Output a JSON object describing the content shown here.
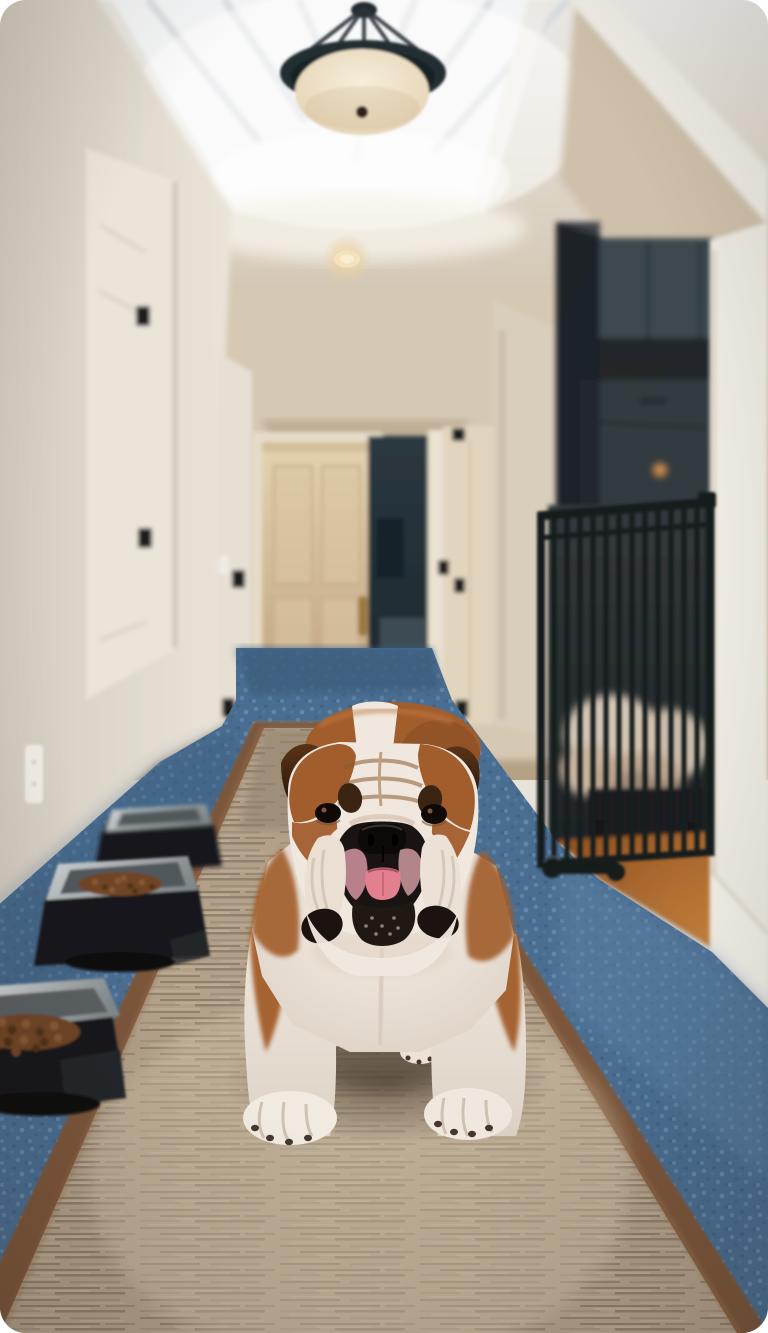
{
  "meta": {
    "media_type": "photograph",
    "subject": "english-bulldog-in-hallway",
    "alt": "A brown and white English Bulldog stands facing the camera on a tan runner rug in a bright hallway with a skylight and pendant light; three raised food bowls line the left wall and a black metal pet gate closes off a room to the right."
  },
  "scene": {
    "dog": {
      "breed": "English Bulldog",
      "coat": "chestnut brown and white",
      "pose": "standing, facing camera",
      "tongue_out": true
    },
    "hallway": {
      "skylight": true,
      "pendant_light": true,
      "recessed_lights": 3,
      "doors_visible": 4,
      "open_doorway": true,
      "wall_outlet": true
    },
    "floor": {
      "carpet": "steel blue",
      "runner": "tan with brown leather binding",
      "wood": "orange oak behind pet gate"
    },
    "objects": [
      "raised dog bowl x3",
      "kibble",
      "black metal pet gate",
      "door mat",
      "brass door handle",
      "fluffy dog bed behind gate"
    ]
  },
  "palette": {
    "wall_left": "#dbd4c9",
    "wall_right": "#edeae2",
    "ceiling": "#d8cdbc",
    "ceiling_deep": "#c2ad93",
    "skylight": "#f4f5f6",
    "skylight_beam": "#d9dcde",
    "pendant_dark": "#242d33",
    "pendant_glass": "#f6eedb",
    "glass_edge": "#e2cfae",
    "recessed_glow": "#f2dcae",
    "end_wall": "#d6c9b3",
    "end_door": "#e4d2b2",
    "end_door_deep": "#bda17c",
    "door_frame": "#e7dcc8",
    "doorway_dark": "#2b3840",
    "doorway_deep": "#1c262d",
    "left_door": "#eae4d9",
    "right_door": "#e2d5bd",
    "hinge": "#1a1a1a",
    "brass": "#9a7634",
    "alcove": "#cec0aa",
    "room_dark": "#262220",
    "cabinet": "#3c4a50",
    "cabinet_dark": "#313b40",
    "knob_light": "#c98a4a",
    "gate": "#171a1d",
    "fluff": "#dccdbc",
    "bench": "#1b1f22",
    "wood": "#8a4d1f",
    "wood_bright": "#c8823c",
    "carpet": "#4a6e92",
    "carpet_light": "#7fa2c0",
    "carpet_dark": "#3c5d7d",
    "runner": "#b2a089",
    "runner_light": "#cdbda4",
    "runner_streak": "#6e5f4e",
    "runner_border": "#7c563a",
    "border_light": "#9a7352",
    "mat": "#c2a87c",
    "bowl": "#17191d",
    "steel": "#d2d6d7",
    "steel_dark": "#82898c",
    "steel_inner": "#51585c",
    "kibble": "#6f4526",
    "kibble_light": "#8a5a34",
    "kibble_dark": "#4e3018",
    "dog_brown": "#a25d2c",
    "dog_brown_deep": "#7e4a20",
    "dog_white": "#f0e8de",
    "dog_shade": "#ddd2c6",
    "ear": "#5a3318",
    "ear_inner": "#241307",
    "muzzle": "#191412",
    "nose": "#0c0a09",
    "tongue": "#e2808f",
    "jowl_pink": "#d493a0",
    "eye": "#0f0a08",
    "nail": "#453730",
    "beard": "#201812",
    "shadow": "#473a2e"
  }
}
